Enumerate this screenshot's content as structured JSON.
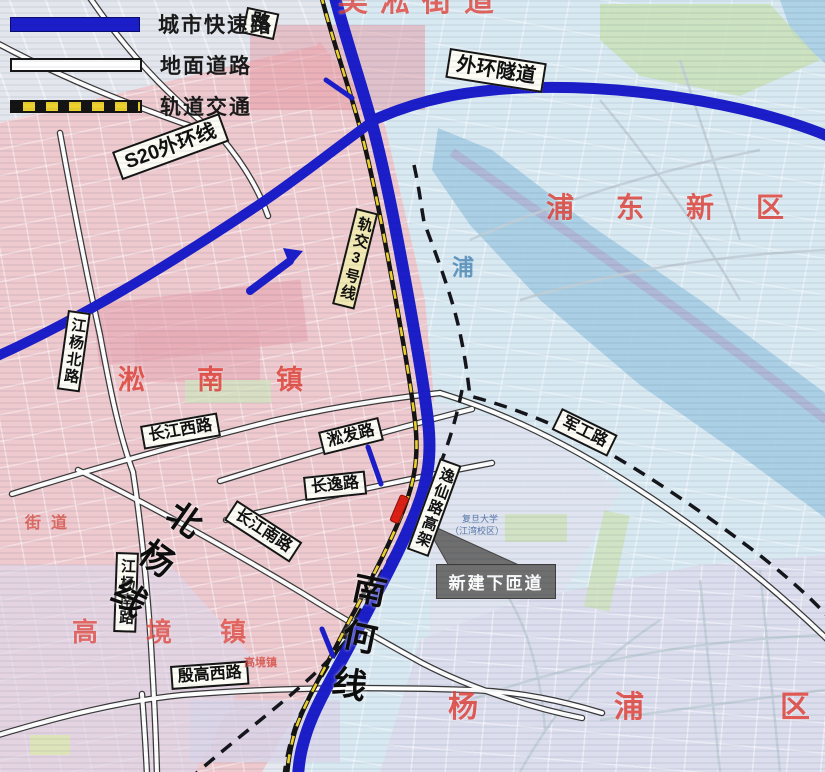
{
  "legend": {
    "items": [
      {
        "key": "expressway",
        "label": "城市快速路"
      },
      {
        "key": "surface-road",
        "label": "地面道路"
      },
      {
        "key": "rail-transit",
        "label": "轨道交通"
      }
    ]
  },
  "road_labels": {
    "s20": "S20外环线",
    "outer_ring_tunnel": "外环隧道",
    "rail_line3": "轨交3号线",
    "jiangyang_north": "江杨北路",
    "changjiang_west": "长江西路",
    "songfa": "淞发路",
    "changyi": "长逸路",
    "changjiang_south": "长江南路",
    "jungong": "军工路",
    "yixian_elevated": "逸仙路高架",
    "jiangyang_south": "江杨南路",
    "yingao_west": "殷高西路",
    "partial_road": "路"
  },
  "railway_labels": {
    "beiyang": "北杨线",
    "nanhe": "南何线"
  },
  "region_labels": {
    "pudong_new_area": "浦东新区",
    "songnan_town": "淞南镇",
    "gaojing_town": "高境镇",
    "yangpu_district": "杨浦区",
    "top_clipped": "吴淞街道"
  },
  "callout": {
    "new_ramp": "新建下匝道"
  },
  "water_labels": {
    "river": "浦"
  },
  "small_labels": {
    "fudan_univ": "复旦大学",
    "fudan_campus": "（江湾校区）",
    "jiedao": "街道",
    "gaojing_small": "高境镇"
  },
  "colors": {
    "expressway_blue": "#1b1ec9",
    "rail_yellow": "#edd22f",
    "region_red": "#e2453c",
    "callout_gray": "#6f6f6f",
    "ramp_marker_red": "#dd2015",
    "water_blue": "#a9cfe4"
  }
}
